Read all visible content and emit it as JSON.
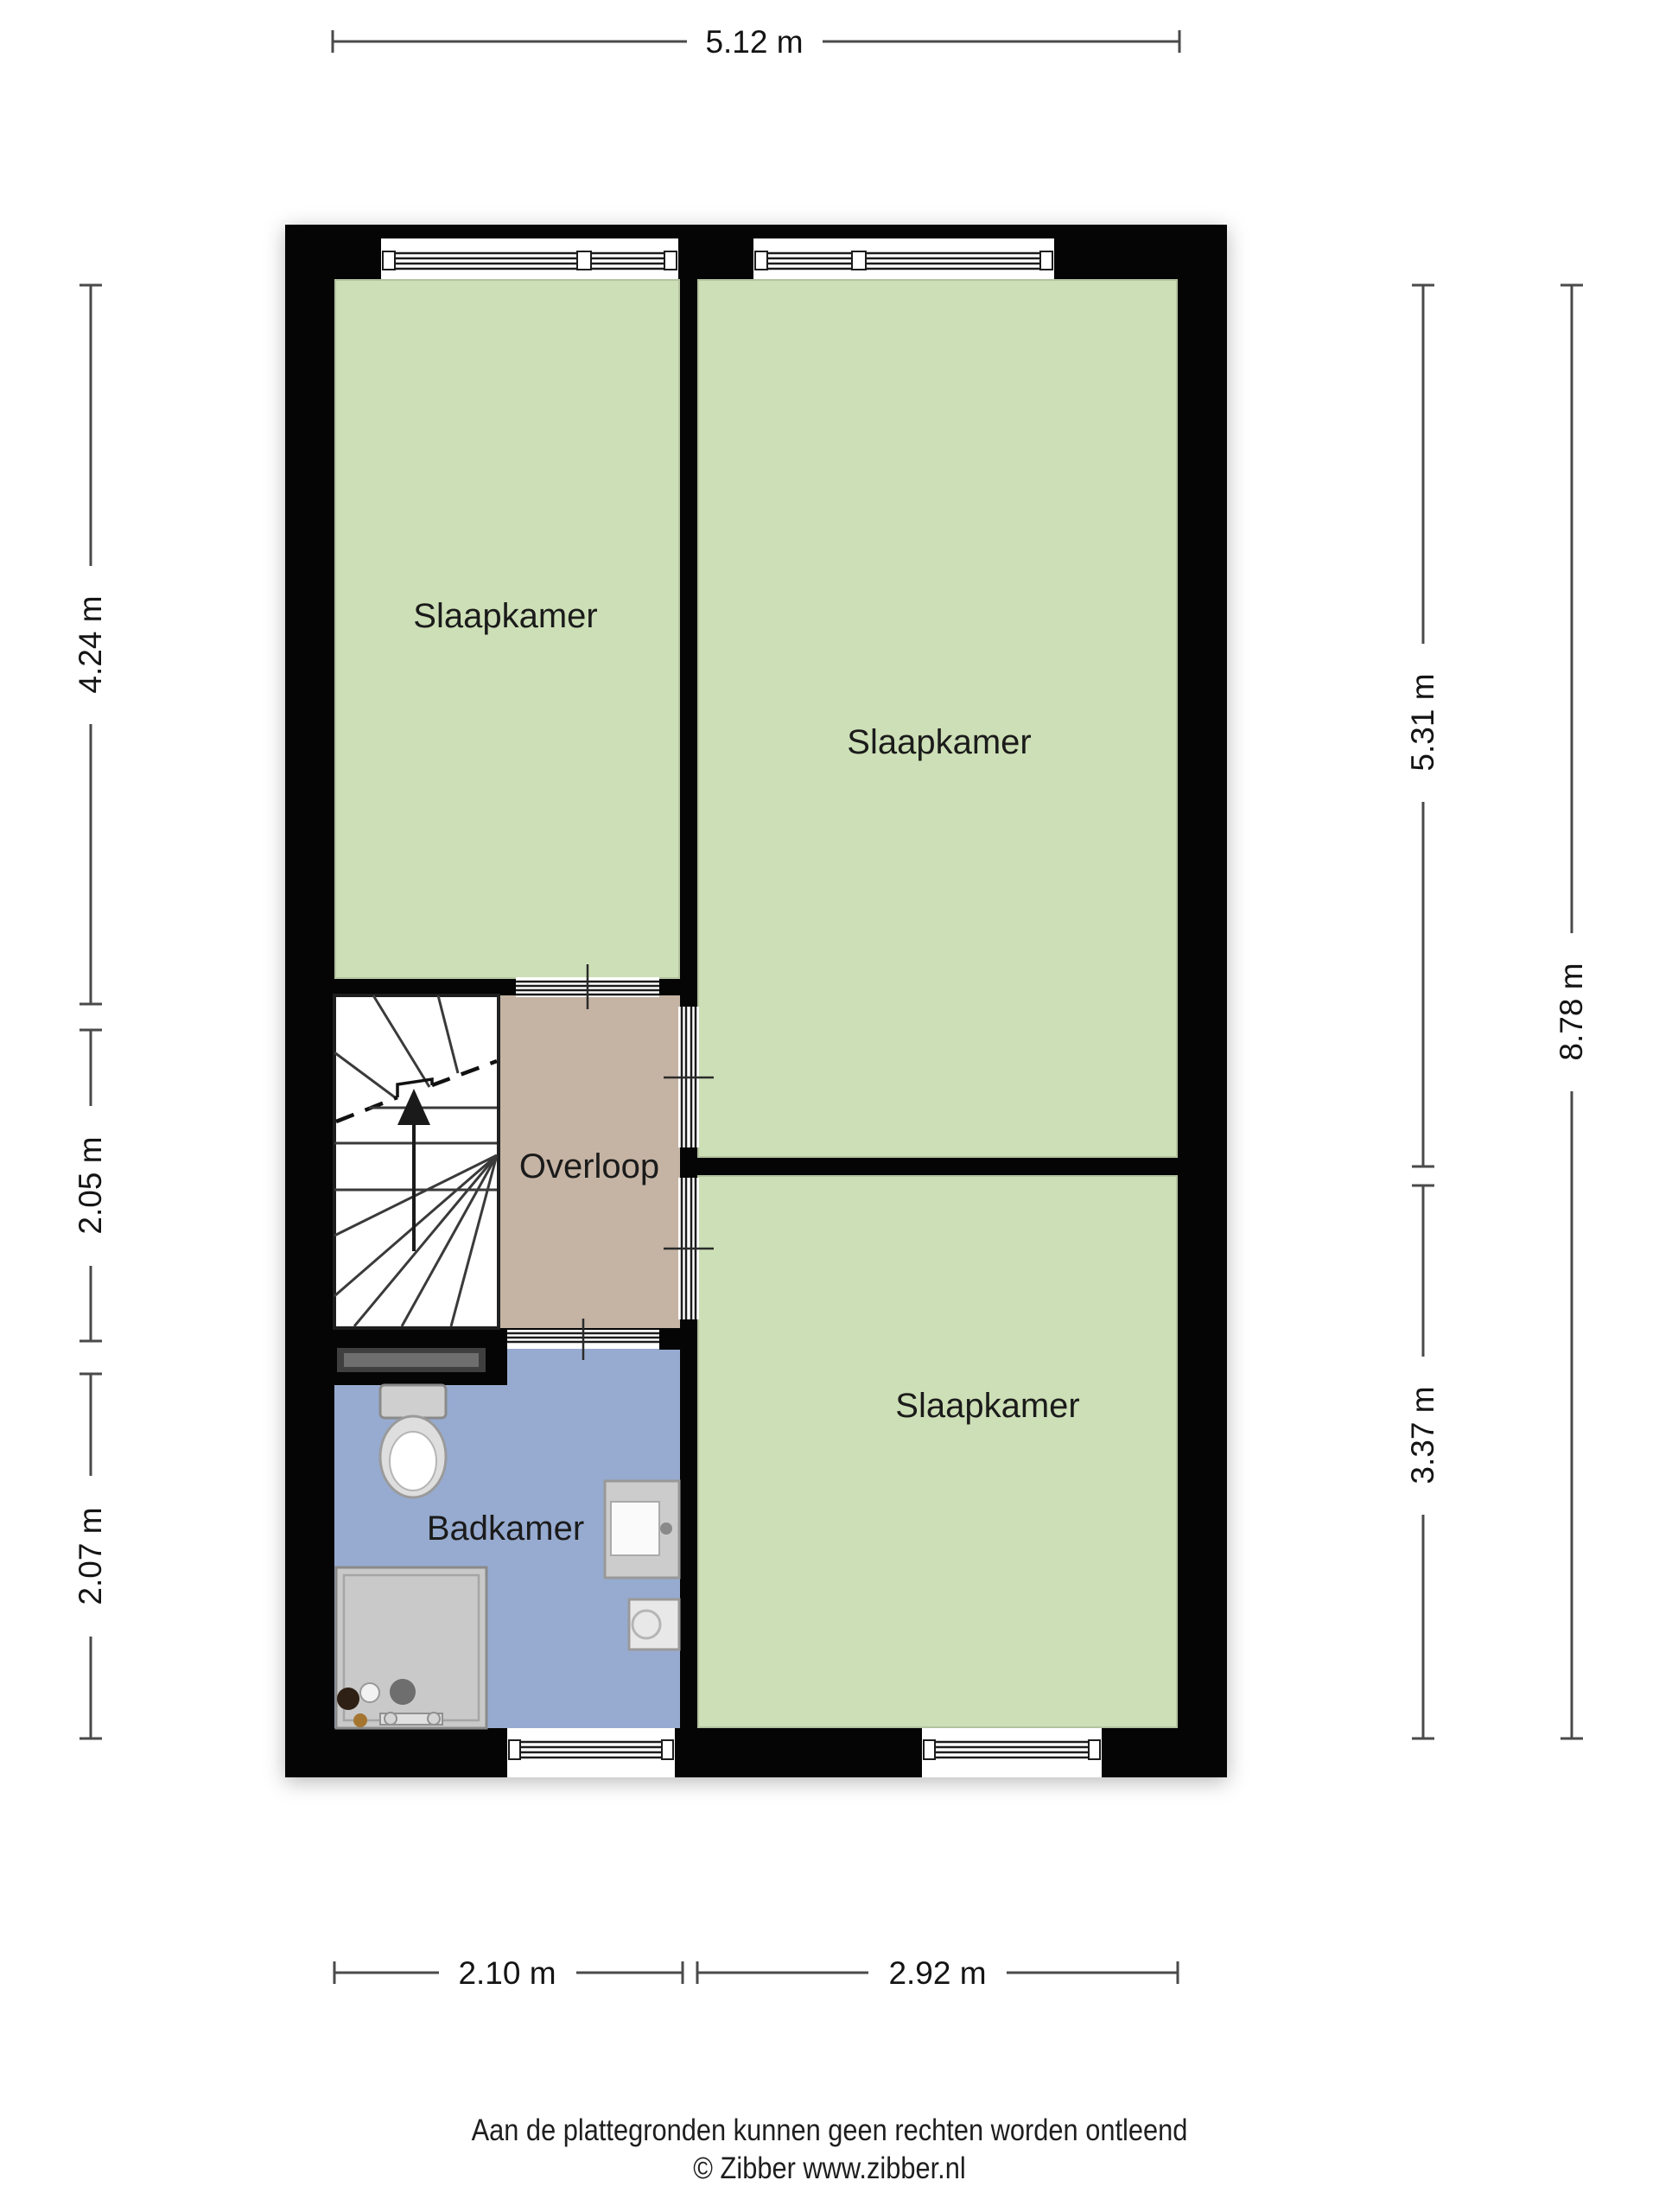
{
  "floorplan": {
    "rooms": [
      {
        "id": "bedroom-top-left",
        "label": "Slaapkamer",
        "color": "#cddfb6"
      },
      {
        "id": "bedroom-top-right",
        "label": "Slaapkamer",
        "color": "#cddfb6"
      },
      {
        "id": "bedroom-bottom-right",
        "label": "Slaapkamer",
        "color": "#cddfb6"
      },
      {
        "id": "landing",
        "label": "Overloop",
        "color": "#c5b4a4"
      },
      {
        "id": "bathroom",
        "label": "Badkamer",
        "color": "#97abd0"
      }
    ],
    "dimensions": {
      "top": "5.12 m",
      "left_top": "4.24 m",
      "left_middle": "2.05 m",
      "left_bottom": "2.07 m",
      "right_inner_top": "5.31 m",
      "right_inner_bottom": "3.37 m",
      "right_outer": "8.78 m",
      "bottom_left": "2.10 m",
      "bottom_right": "2.92 m"
    },
    "wall_color": "#050505",
    "stairwell_color": "#ffffff"
  },
  "footer": {
    "disclaimer": "Aan de plattegronden kunnen geen rechten worden ontleend",
    "copyright": "© Zibber www.zibber.nl"
  }
}
